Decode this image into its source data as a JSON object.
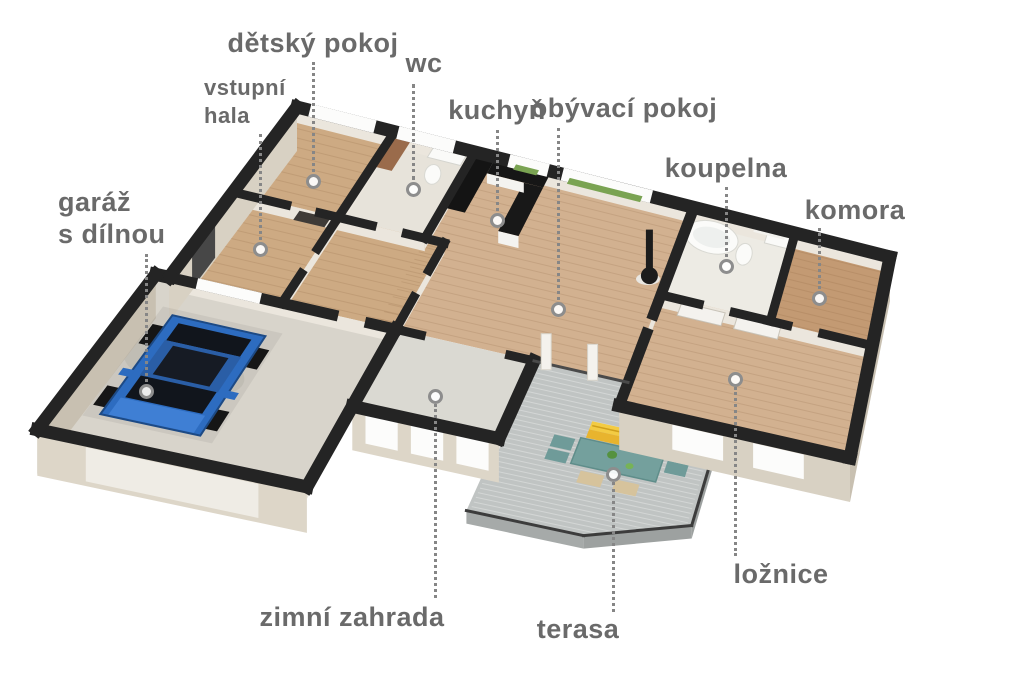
{
  "scene": {
    "type": "3d-floor-plan-axonometric",
    "description": "3D cutaway floor plan of a single-storey house with attached garage, winter garden and terrace, viewed from above at an angle",
    "background": "#ffffff"
  },
  "rooms": [
    {
      "id": "detsky-pokoj",
      "label": "dětský pokoj"
    },
    {
      "id": "vstupni-hala",
      "label": "vstupní hala",
      "lines": [
        "vstupní",
        "hala"
      ]
    },
    {
      "id": "wc",
      "label": "wc"
    },
    {
      "id": "kuchyn",
      "label": "kuchyň"
    },
    {
      "id": "obyvaci-pokoj",
      "label": "obývací pokoj"
    },
    {
      "id": "koupelna",
      "label": "koupelna"
    },
    {
      "id": "komora",
      "label": "komora"
    },
    {
      "id": "garaz-s-dilnou",
      "label": "garáž s dílnou",
      "lines": [
        "garáž",
        "s dílnou"
      ]
    },
    {
      "id": "zimni-zahrada",
      "label": "zimní zahrada"
    },
    {
      "id": "terasa",
      "label": "terasa"
    },
    {
      "id": "loznice",
      "label": "ložnice"
    }
  ],
  "palette": {
    "label_text": "#6a6a6a",
    "leader_line": "#868686",
    "marker_ring": "#8d8d8d",
    "wall": "#242424",
    "wood_floor": "#d2b190",
    "wood_floor_warm": "#cdaa83",
    "komora_floor": "#c39a73",
    "tile_wc": "#e7e3da",
    "tile_bath": "#edebe4",
    "garage_floor": "#d8d4cb",
    "zimni_floor": "#dad9d2",
    "deck": "#c0c4c3",
    "deck_line": "#d3d6d5",
    "facade": "#d8d1c3",
    "facade_shaded": "#c8c0b1",
    "facade_light": "#ddd6c8",
    "inner_wall_face": "#ebe6dd",
    "window_white": "#fcfcfb",
    "car_blue": "#2d6cc0",
    "car_roof": "#2a5ea6",
    "car_glass": "#11151c",
    "table_teal": "#74a09d",
    "chair_teal": "#6f9b99",
    "bench_yellow": "#e8b42e",
    "wicker": "#d6c39c",
    "plant_green": "#7aa352",
    "stove_black": "#1c1c1c"
  }
}
